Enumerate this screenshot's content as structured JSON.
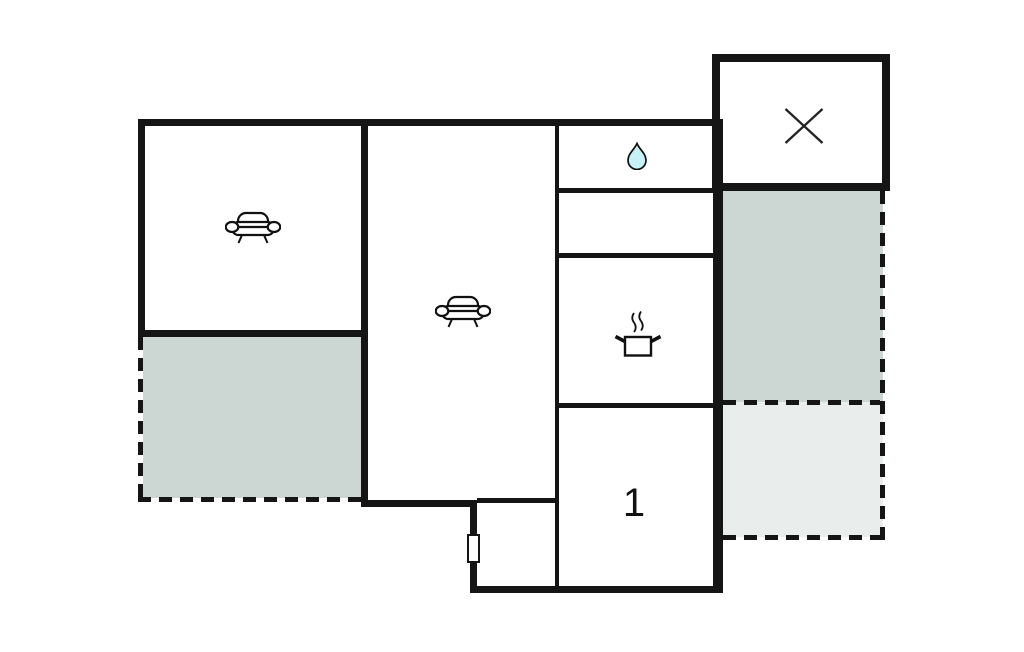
{
  "floorplan": {
    "type": "house-floor-plan",
    "colors": {
      "wall": "#151515",
      "terrace_dark": "#ccd6d3",
      "terrace_light": "#e9edeb",
      "water_drop": "#c6f1f6",
      "background": "#ffffff"
    },
    "rooms": [
      {
        "name": "living-room-left",
        "icon": "sofa-icon",
        "label": ""
      },
      {
        "name": "living-room-center",
        "icon": "sofa-icon",
        "label": ""
      },
      {
        "name": "bathroom",
        "icon": "water-drop-icon",
        "label": ""
      },
      {
        "name": "storage-room",
        "icon": "",
        "label": ""
      },
      {
        "name": "kitchen",
        "icon": "cooking-pot-icon",
        "label": ""
      },
      {
        "name": "bedroom-1",
        "icon": "",
        "label": "1"
      },
      {
        "name": "x-room",
        "icon": "x-icon",
        "label": ""
      },
      {
        "name": "terrace-left",
        "icon": "",
        "label": ""
      },
      {
        "name": "terrace-right-upper",
        "icon": "",
        "label": ""
      },
      {
        "name": "terrace-right-lower",
        "icon": "",
        "label": ""
      },
      {
        "name": "entry-vestibule",
        "icon": "window-marker",
        "label": ""
      }
    ]
  }
}
